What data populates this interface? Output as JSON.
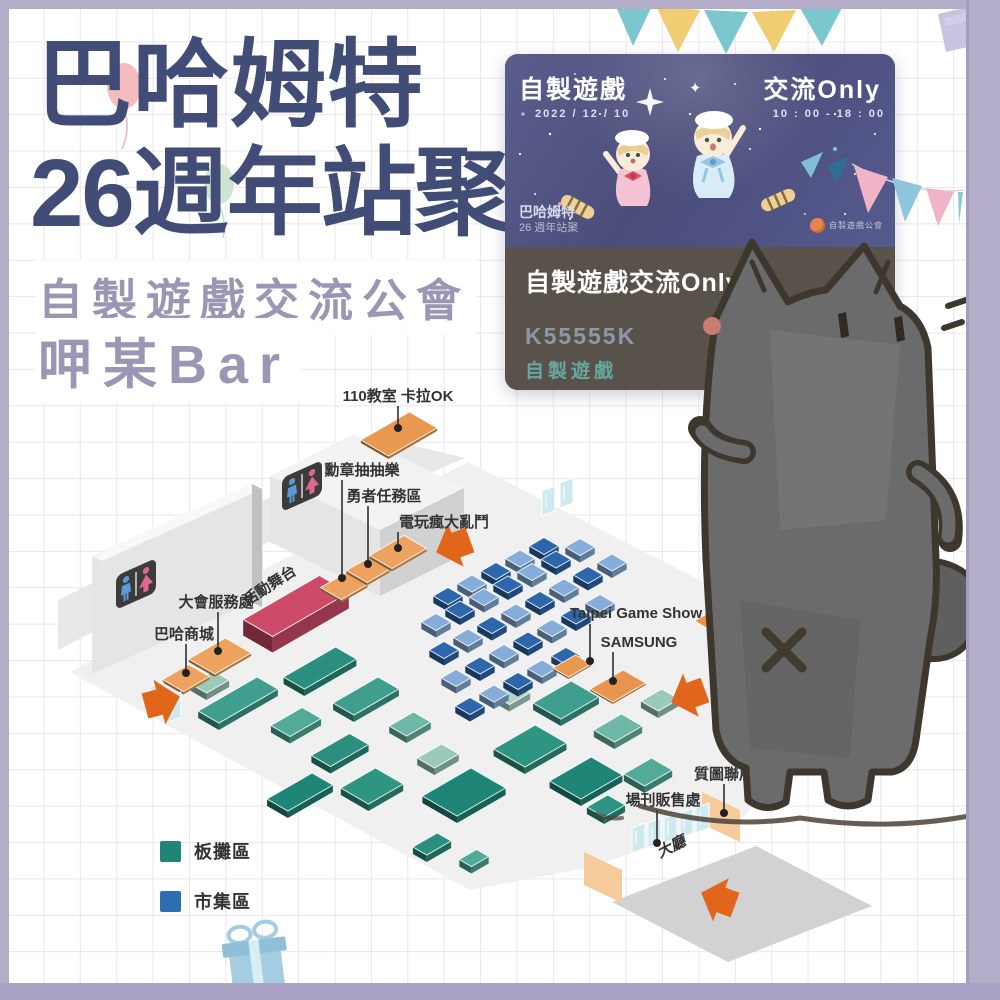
{
  "header": {
    "title_line1": "巴哈姆特",
    "title_line2": "26週年站聚",
    "subtitle": "自製遊戲交流公會",
    "booth_name": "呷某Bar"
  },
  "event_card": {
    "poster": {
      "title_left": "自製遊戲",
      "star": "✦",
      "title_right": "交流Only",
      "date": "2022 / 12 / 10",
      "time": "10 : 00 - 18 : 00",
      "brand_line1": "巴哈姆特",
      "brand_line2": "26 週年站聚",
      "logo_text": "自製遊戲公會"
    },
    "booth_title": "自製遊戲交流Only",
    "booth_code": "K55555K",
    "booth_category": "自製遊戲"
  },
  "map": {
    "area_labels": {
      "karaoke": "110教室 卡拉OK",
      "badge_draw": "勳章抽抽樂",
      "hero_quest": "勇者任務區",
      "game_battle": "電玩瘋大亂鬥",
      "service_desk": "大會服務處",
      "stage": "活動舞台",
      "mall": "巴哈商城",
      "outdoor_car": "戶外痛車展示區",
      "tgs": "Taipei Game Show",
      "samsung": "SAMSUNG",
      "art_expo": "質圖聯展",
      "program_sales": "場刊販售處",
      "lobby": "大廳"
    },
    "legend": [
      {
        "label": "板攤區",
        "color": "#1f8576"
      },
      {
        "label": "市集區",
        "color": "#2f6fb0"
      }
    ]
  }
}
